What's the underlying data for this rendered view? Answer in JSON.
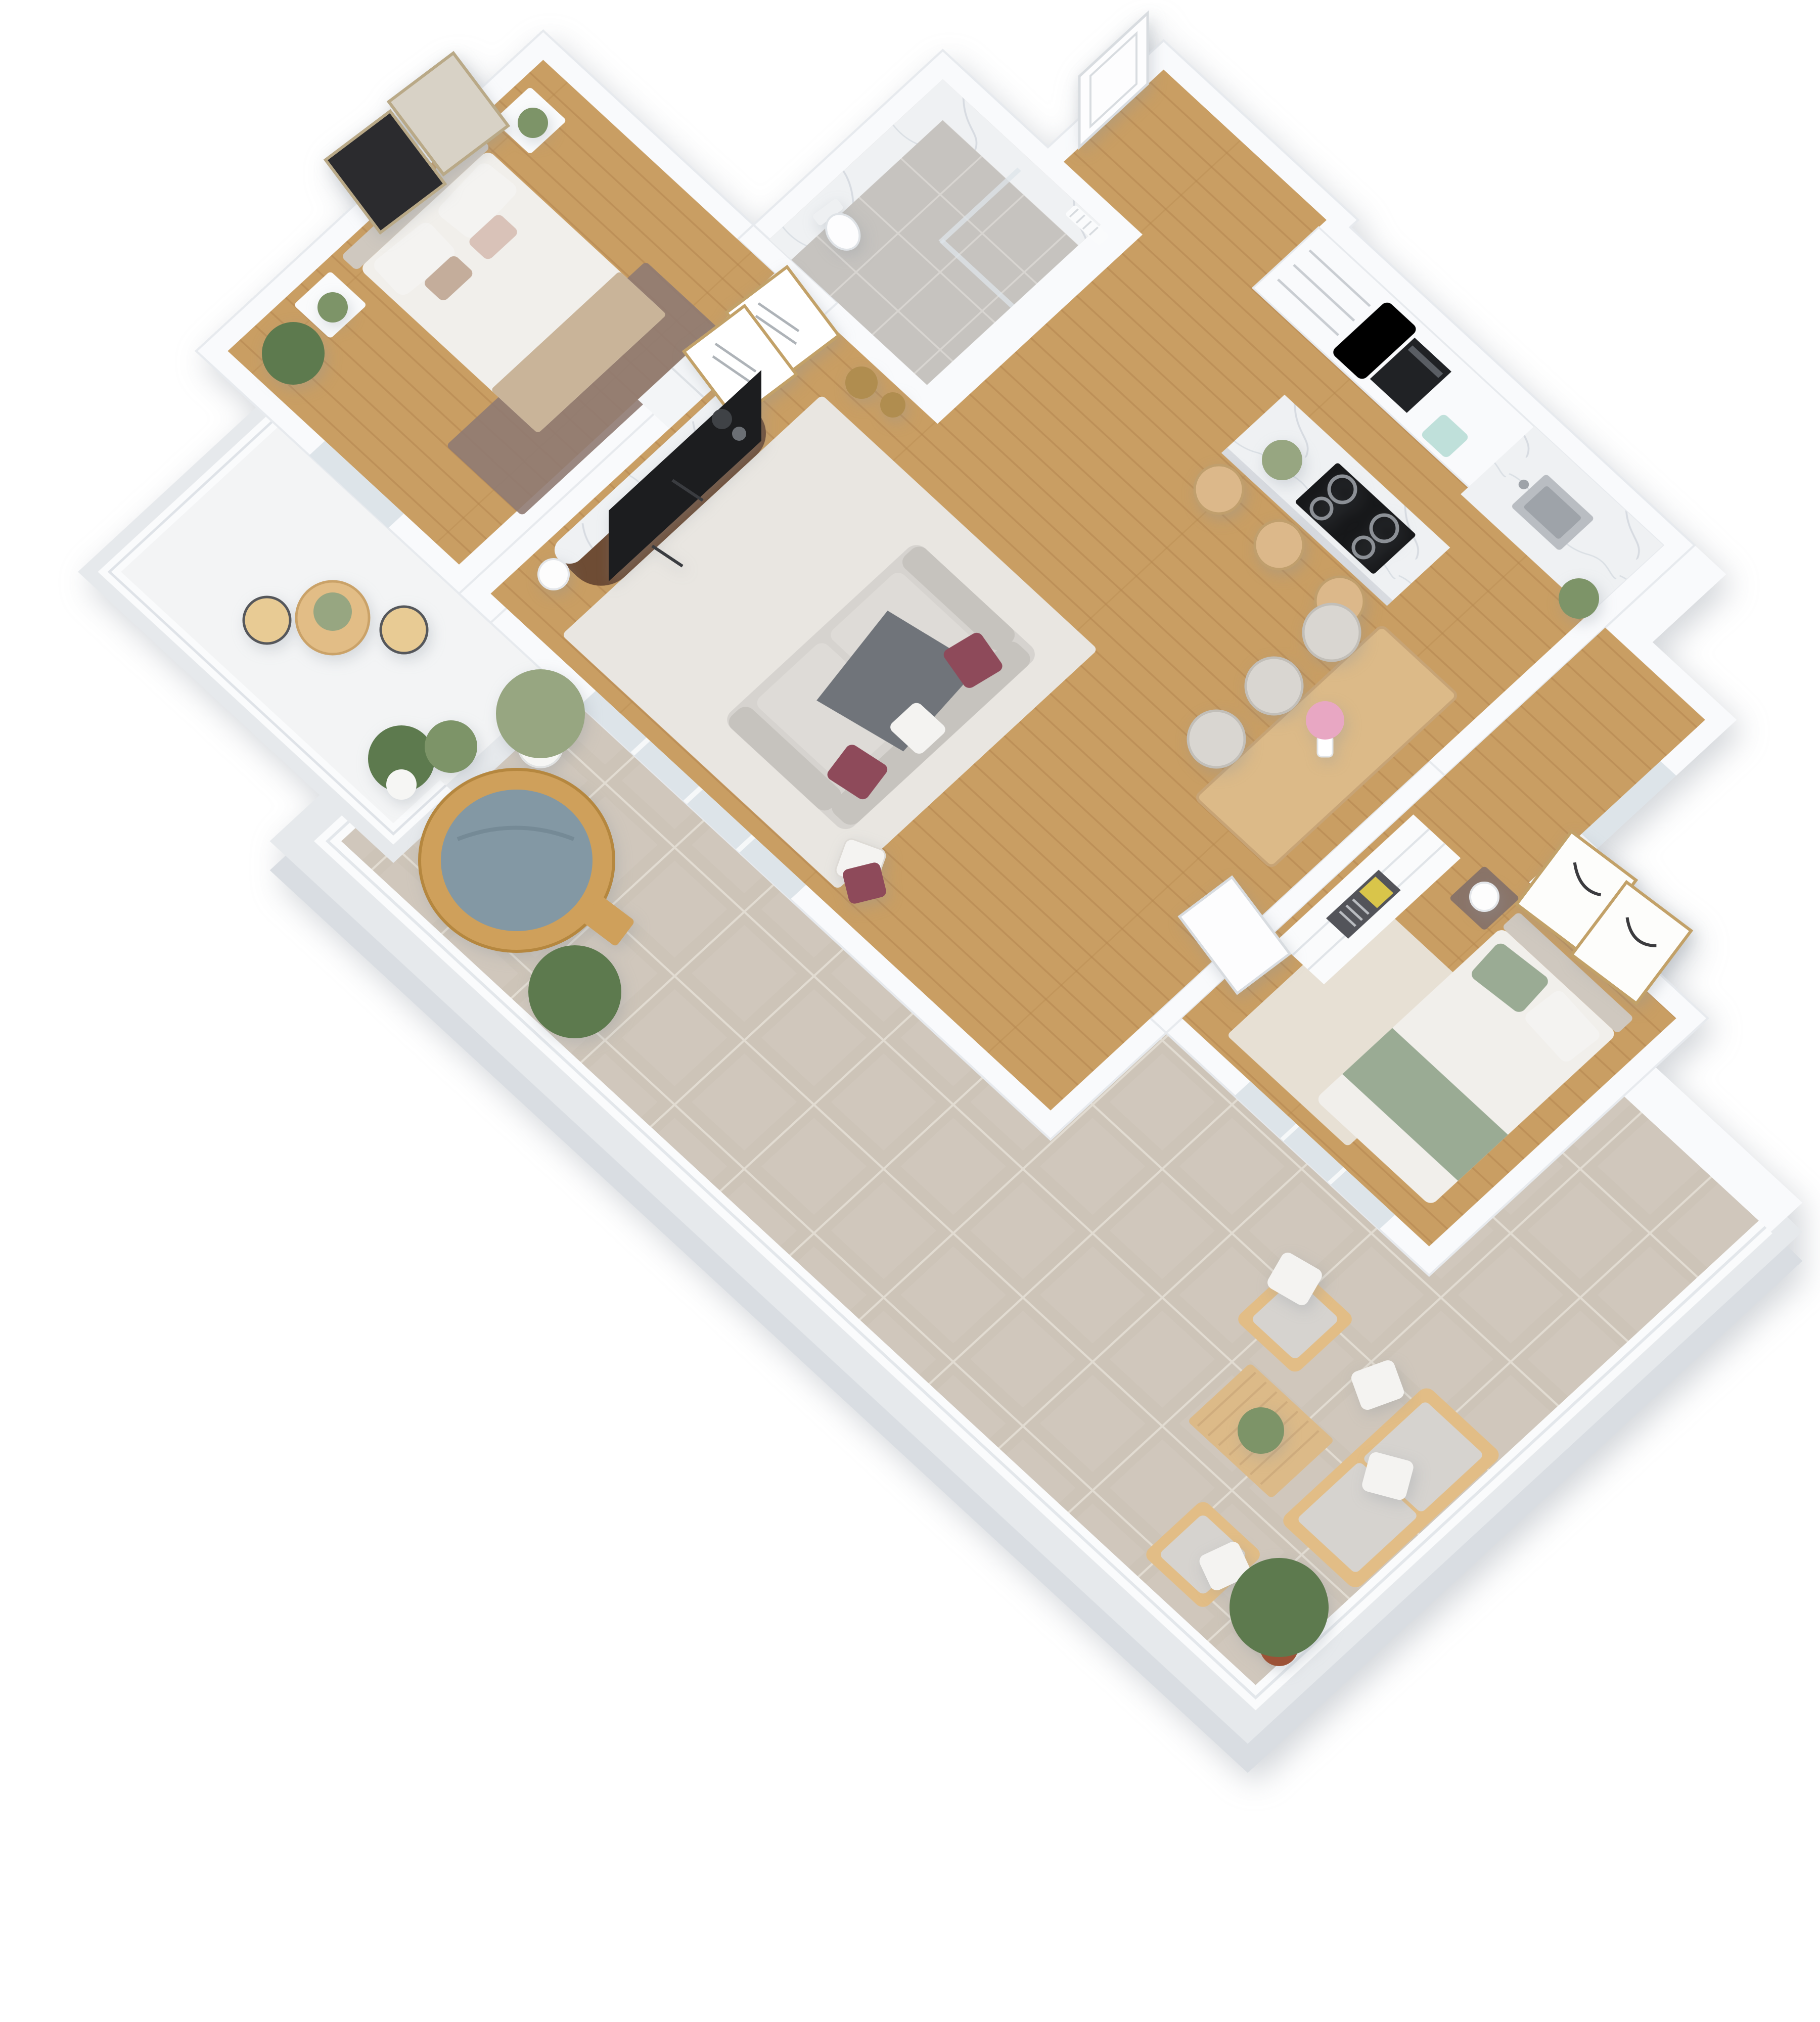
{
  "scene": {
    "type": "isometric-3d-floor-plan",
    "description": "Top-down 3D render of a two-bedroom apartment with open kitchen/living area, bathroom, bistro balcony and large wraparound tiled terrace with hot tub and outdoor lounge set",
    "projection": "plan rotated 45 degrees, axonometric top view",
    "background": "#ffffff"
  },
  "colors": {
    "wall": "#f9fafc",
    "wall_seam": "#e7eaee",
    "wall_side": "#eef0f3",
    "floor_wood": "#c99e63",
    "floor_wood_line": "#b3854e",
    "tile": "#cdc4b8",
    "tile_grout": "#e2dcd2",
    "slab": "#e6e9ec",
    "slab_side": "#d9dde2",
    "bath_tile": "#c6c3bf",
    "bath_grout": "#d8d5d1",
    "marble": "#eff1f3",
    "marble_vein": "#c6cdd5",
    "glass": "#dde4e9",
    "rail": "#fafbfc",
    "sofa": "#d6d3cf",
    "sofa_dark": "#c6c3be",
    "seat": "#dedbd7",
    "throw_gray": "#70747a",
    "burgundy": "#8e4a5a",
    "pillow_white": "#f4f3f1",
    "rug_living": "#e9e6e1",
    "rug_master": "#8f7a72",
    "rug_bedroom2": "#e7e0d4",
    "duvet": "#f1efeb",
    "blanket_beige": "#c9b499",
    "headboard": "#cfc8bf",
    "sage": "#9aab94",
    "nightstand_dark": "#8a7468",
    "walnut": "#6e4c34",
    "tv_black": "#1c1d1f",
    "hob_black": "#17181a",
    "oven_black": "#202225",
    "toaster_mint": "#bfe0da",
    "steel": "#b9bdc2",
    "steel_dark": "#9ea3a9",
    "oak": "#dcba88",
    "oak_edge": "#c7a476",
    "stool_wood": "#dcb88a",
    "chair_gray": "#d9d6d1",
    "gold": "#b08d4f",
    "tub_wood": "#cfa05b",
    "water": "#8398a4",
    "plant_green": "#7d9468",
    "plant_dark": "#5d7a4e",
    "olive_green": "#97a681",
    "terracotta": "#9c5236",
    "pot_white": "#f6f6f4",
    "balcony_floor": "#f3f4f5",
    "bistro_wood": "#e2bd86",
    "art_dark": "#2b2b2e",
    "art_light": "#d8d2c6",
    "frame_gold": "#c2a168",
    "sketch_gray": "#9aa0a6",
    "blossom_pink": "#e8a7c3",
    "door_white": "#fdfdfe",
    "door_line": "#d8dce0"
  },
  "rooms": [
    {
      "id": "entrance-hall",
      "label": "Entrance hall"
    },
    {
      "id": "bathroom",
      "label": "Bathroom"
    },
    {
      "id": "hallway",
      "label": "Hallway"
    },
    {
      "id": "kitchen",
      "label": "Kitchen"
    },
    {
      "id": "living-room",
      "label": "Living room"
    },
    {
      "id": "dining-area",
      "label": "Dining area"
    },
    {
      "id": "master-bedroom",
      "label": "Master bedroom"
    },
    {
      "id": "second-bedroom",
      "label": "Second bedroom"
    },
    {
      "id": "balcony",
      "label": "Bistro balcony"
    },
    {
      "id": "terrace",
      "label": "Terrace"
    }
  ],
  "furniture": {
    "master_bedroom": [
      "double bed",
      "two framed artworks",
      "two white nightstands",
      "potted plants",
      "mauve rug",
      "wardrobe"
    ],
    "bathroom": [
      "walk-in shower",
      "marble walls",
      "toilet",
      "towel radiator"
    ],
    "kitchen": [
      "tall cabinets",
      "built-in oven",
      "mint toaster",
      "marble counter with sink",
      "marble island with induction hob",
      "three wooden stools"
    ],
    "living_room": [
      "gray sofa with burgundy pillows",
      "gray throw",
      "light rug",
      "walnut TV sideboard",
      "flat TV",
      "table lamp",
      "gold vases",
      "two framed sketches"
    ],
    "dining_area": [
      "oak dining table",
      "gray chairs",
      "pink flower vase"
    ],
    "second_bedroom": [
      "bed with sage bedding",
      "sliding wardrobe",
      "dark nightstand",
      "sphere lamp",
      "two framed artworks",
      "beige rug"
    ],
    "balcony": [
      "bistro table",
      "two folding chairs",
      "potted plants",
      "white railing"
    ],
    "terrace": [
      "wooden hot tub",
      "step ladder",
      "olive plant",
      "outdoor sofa",
      "two outdoor armchairs",
      "slatted coffee table",
      "pine plants",
      "tile floor",
      "white parapet"
    ]
  }
}
